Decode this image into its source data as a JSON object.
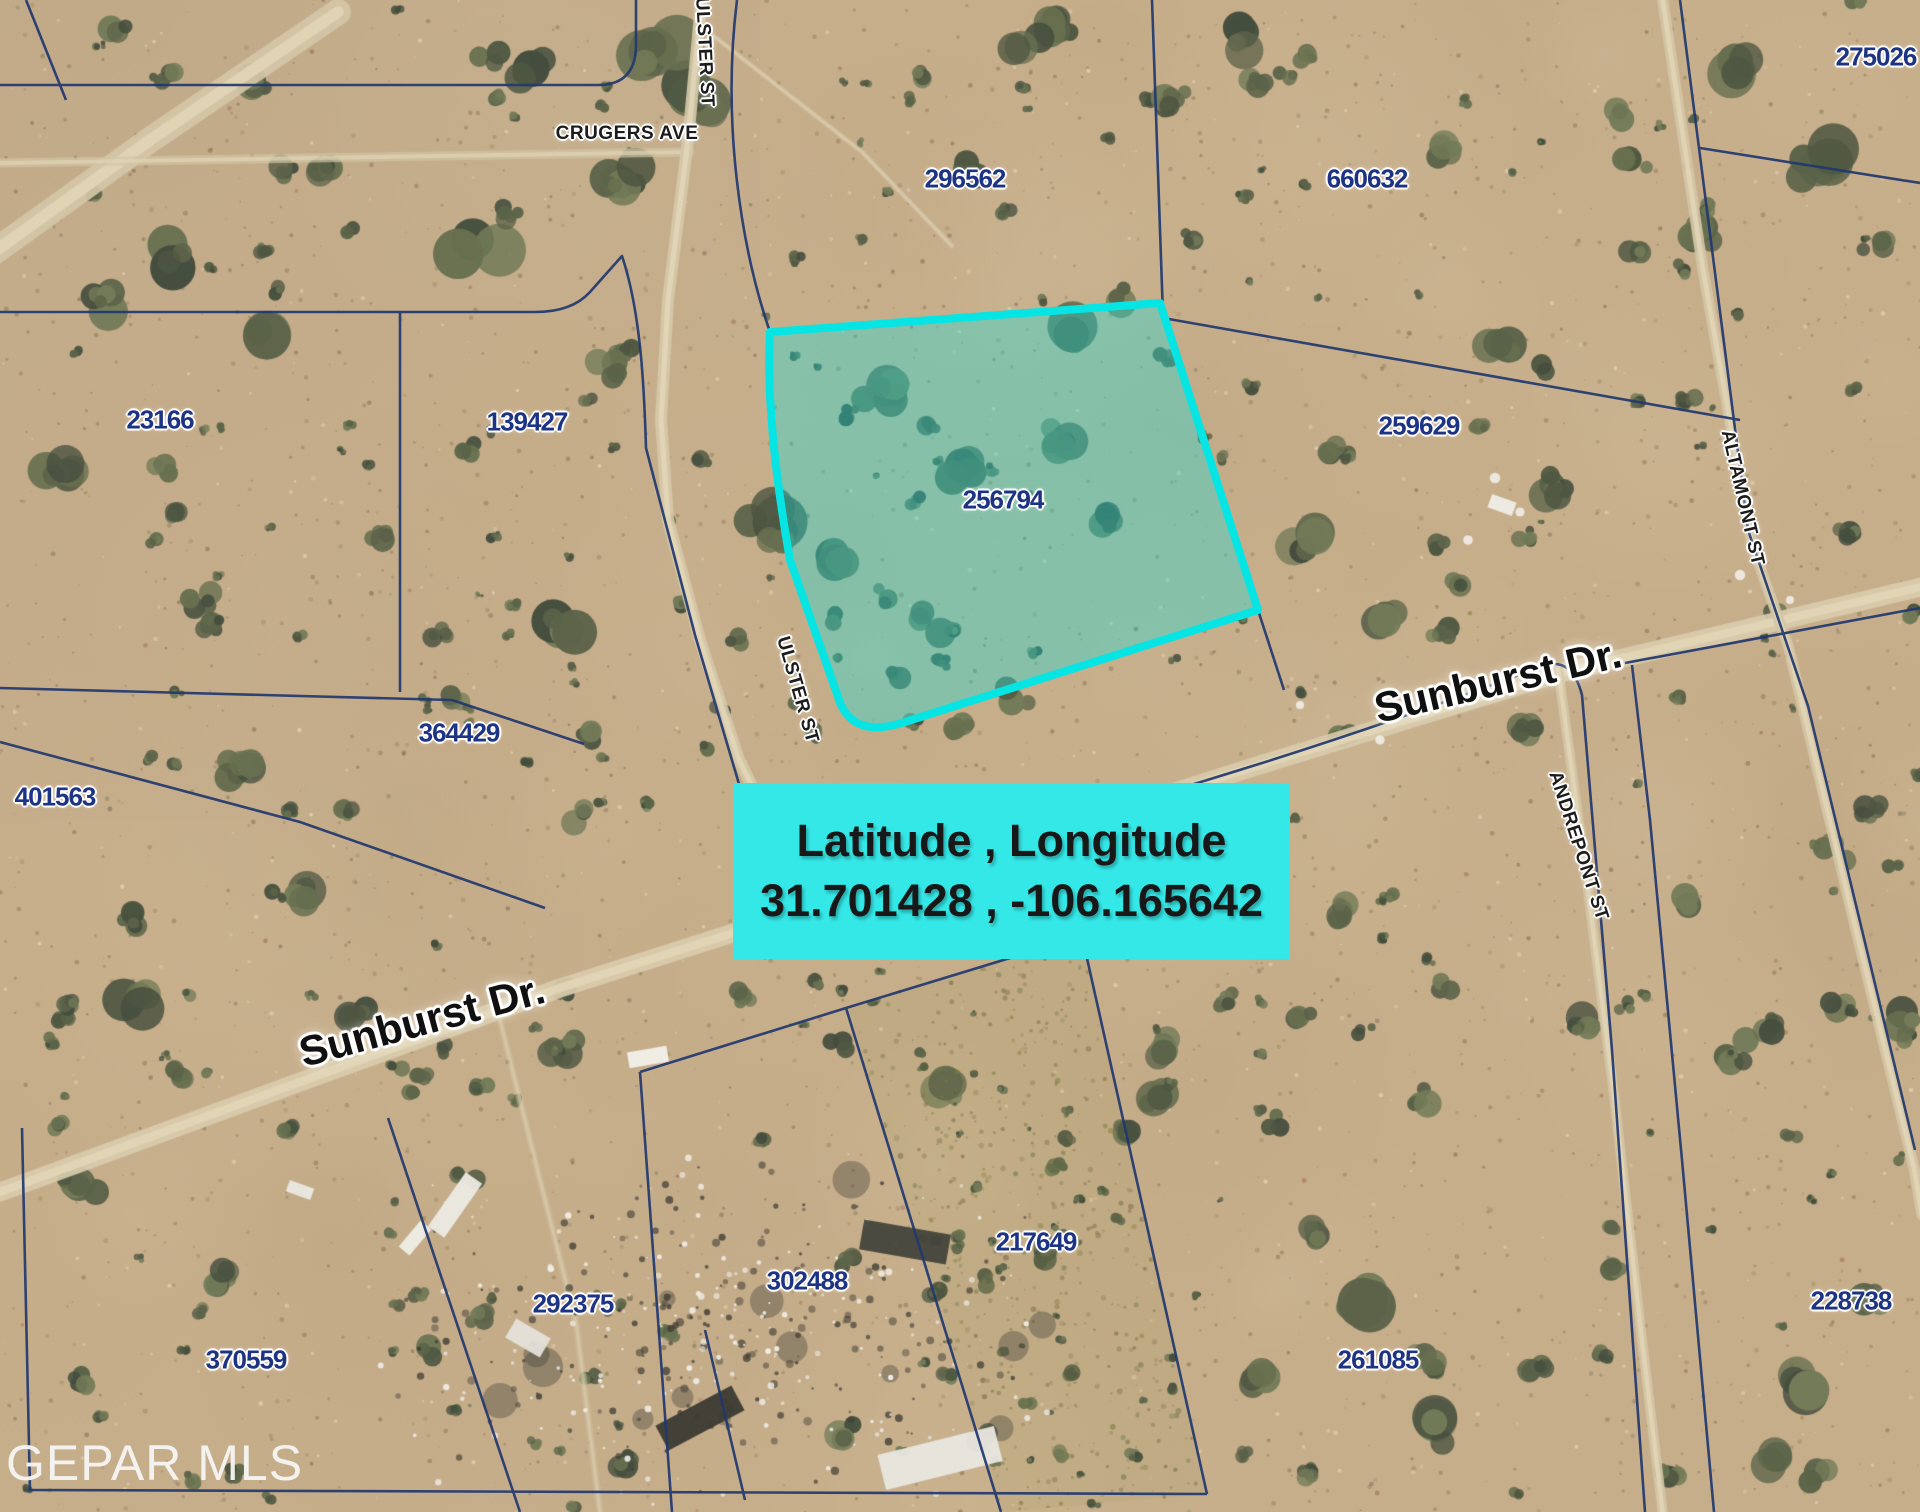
{
  "map": {
    "watermark": "GEPAR MLS",
    "coordinate_box": {
      "title": "Latitude , Longitude",
      "coordinates": "31.701428 , -106.165642"
    },
    "highlighted_parcel_id": "256794",
    "streets": [
      {
        "name": "CRUGERS AVE",
        "x": 627,
        "y": 134,
        "rot": 0,
        "size": "small"
      },
      {
        "name": "ULSTER ST",
        "x": 704,
        "y": 52,
        "rot": 87,
        "size": "small"
      },
      {
        "name": "ULSTER ST",
        "x": 797,
        "y": 690,
        "rot": 74,
        "size": "small"
      },
      {
        "name": "ALTAMONT ST",
        "x": 1742,
        "y": 498,
        "rot": 77,
        "size": "small"
      },
      {
        "name": "ANDREPONT ST",
        "x": 1578,
        "y": 846,
        "rot": 72,
        "size": "small"
      },
      {
        "name": "Sunburst Dr.",
        "x": 1498,
        "y": 681,
        "rot": -13,
        "size": "large"
      },
      {
        "name": "Sunburst Dr.",
        "x": 422,
        "y": 1021,
        "rot": -15,
        "size": "large"
      }
    ],
    "parcels": [
      {
        "id": "275026",
        "x": 1876,
        "y": 57
      },
      {
        "id": "296562",
        "x": 965,
        "y": 179
      },
      {
        "id": "660632",
        "x": 1367,
        "y": 179
      },
      {
        "id": "23166",
        "x": 160,
        "y": 420
      },
      {
        "id": "139427",
        "x": 527,
        "y": 422
      },
      {
        "id": "259629",
        "x": 1419,
        "y": 426
      },
      {
        "id": "256794",
        "x": 1003,
        "y": 500
      },
      {
        "id": "364429",
        "x": 459,
        "y": 733
      },
      {
        "id": "401563",
        "x": 55,
        "y": 797
      },
      {
        "id": "217649",
        "x": 1036,
        "y": 1242
      },
      {
        "id": "302488",
        "x": 807,
        "y": 1281
      },
      {
        "id": "292375",
        "x": 573,
        "y": 1304
      },
      {
        "id": "370559",
        "x": 246,
        "y": 1360
      },
      {
        "id": "261085",
        "x": 1378,
        "y": 1360
      },
      {
        "id": "228738",
        "x": 1851,
        "y": 1301
      }
    ]
  },
  "colors": {
    "highlight_border": "#06e4e4",
    "highlight_fill": "rgba(11,230,225,0.34)",
    "parcel_number": "#1d3383",
    "boundary_line": "#21386f",
    "label_box_bg": "#35e8e8",
    "sand_base": "#c7ae8b"
  }
}
